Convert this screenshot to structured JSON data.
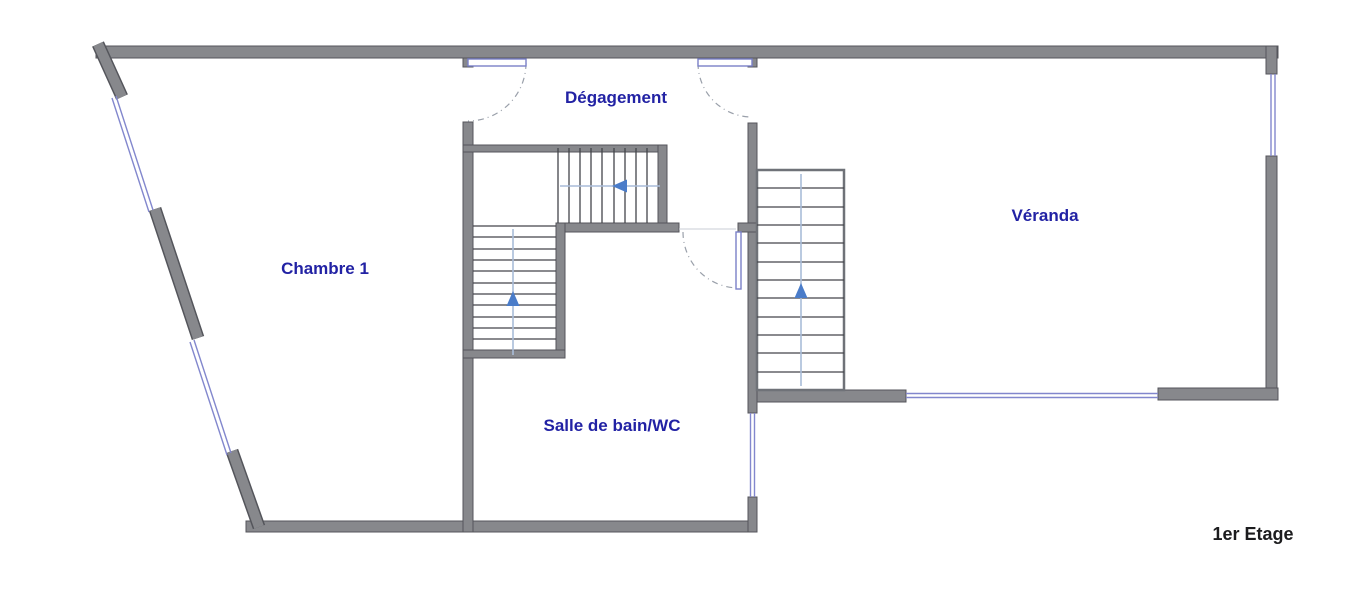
{
  "plan": {
    "type": "floor-plan",
    "floor_label": "1er Etage",
    "rooms": [
      {
        "id": "chambre-1",
        "label": "Chambre 1"
      },
      {
        "id": "degagement",
        "label": "Dégagement"
      },
      {
        "id": "salle-de-bain",
        "label": "Salle de bain/WC"
      },
      {
        "id": "veranda",
        "label": "Véranda"
      }
    ],
    "stairs": [
      {
        "id": "upper-run",
        "arrow_direction": "left"
      },
      {
        "id": "lower-run",
        "arrow_direction": "up"
      },
      {
        "id": "veranda-run",
        "arrow_direction": "up"
      }
    ],
    "door_count": 3,
    "window_count": 5
  },
  "colors": {
    "wall_fill": "#87888c",
    "wall_outline": "#54555b",
    "window_blue": "#8287cd",
    "stair_tread": "#43454a",
    "arrow_line": "#a9bcd9",
    "arrow_head": "#4a7cc9",
    "door_leaf": "#7a80c8",
    "door_swing": "#9aa0aa",
    "room_label": "#2222a4",
    "floor_label": "#1c1c1e",
    "background": "#ffffff"
  }
}
